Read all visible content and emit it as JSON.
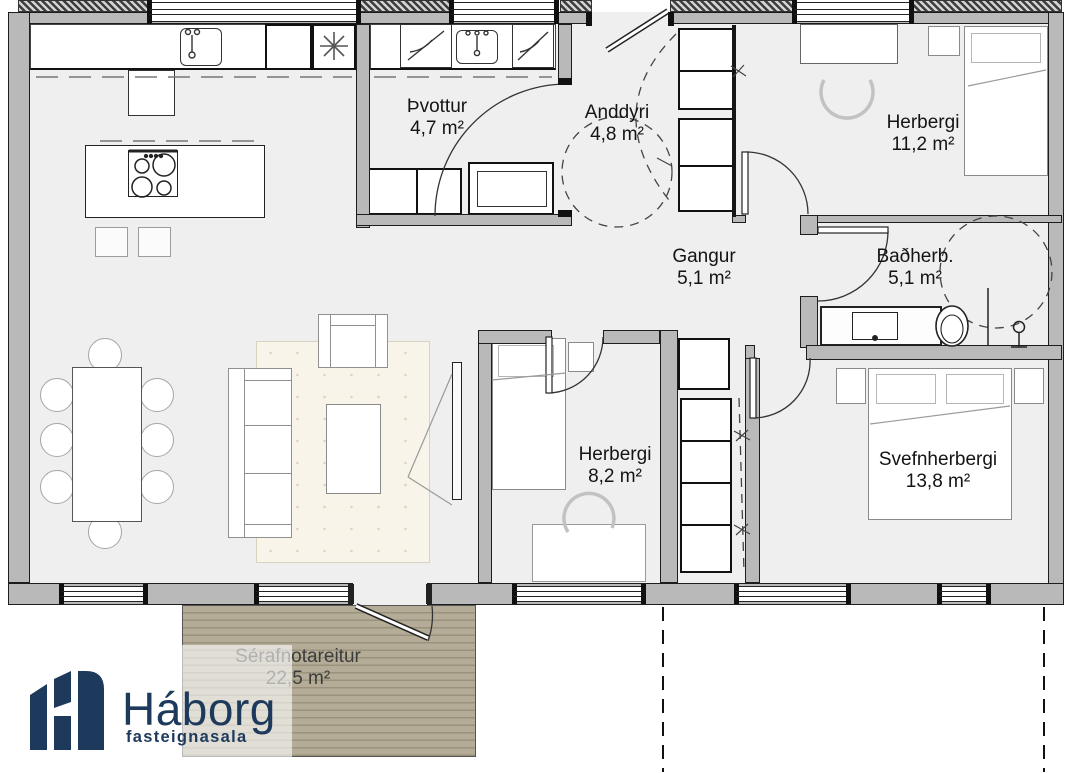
{
  "brand": {
    "name": "Háborg",
    "tagline": "fasteignasala",
    "color": "#1d3a5c"
  },
  "floorplan": {
    "rooms": [
      {
        "id": "thvottur",
        "name": "Þvottur",
        "area": "4,7 m²"
      },
      {
        "id": "anddyri",
        "name": "Anddyri",
        "area": "4,8 m²"
      },
      {
        "id": "herbergi-1",
        "name": "Herbergi",
        "area": "11,2 m²"
      },
      {
        "id": "gangur",
        "name": "Gangur",
        "area": "5,1 m²"
      },
      {
        "id": "badherbergi",
        "name": "Baðherb.",
        "area": "5,1 m²"
      },
      {
        "id": "herbergi-2",
        "name": "Herbergi",
        "area": "8,2 m²"
      },
      {
        "id": "svefnherbergi",
        "name": "Svefnherbergi",
        "area": "13,8 m²"
      },
      {
        "id": "serafnotareitur",
        "name": "Sérafnotareitur",
        "area": "22,5 m²"
      }
    ],
    "colors": {
      "floor": "#efefef",
      "wall": "#b9b9b9",
      "wall_outline": "#1a1a1a",
      "deck": "#b4ac96",
      "rug": "#f8f4e9",
      "brand_navy": "#1d3a5c"
    },
    "symbols": {
      "stove-icon": "4 burner circles",
      "sink-icon": "rounded basin with faucet",
      "floor-drain-icon": "asterisk",
      "shower-icon": "dashed circle with shower head",
      "toilet-icon": "ellipse",
      "washer-icon": "box with diagonal slash",
      "door-icon": "leaf with quarter-circle swing arc",
      "window-icon": "double glazing lines in wall"
    }
  }
}
